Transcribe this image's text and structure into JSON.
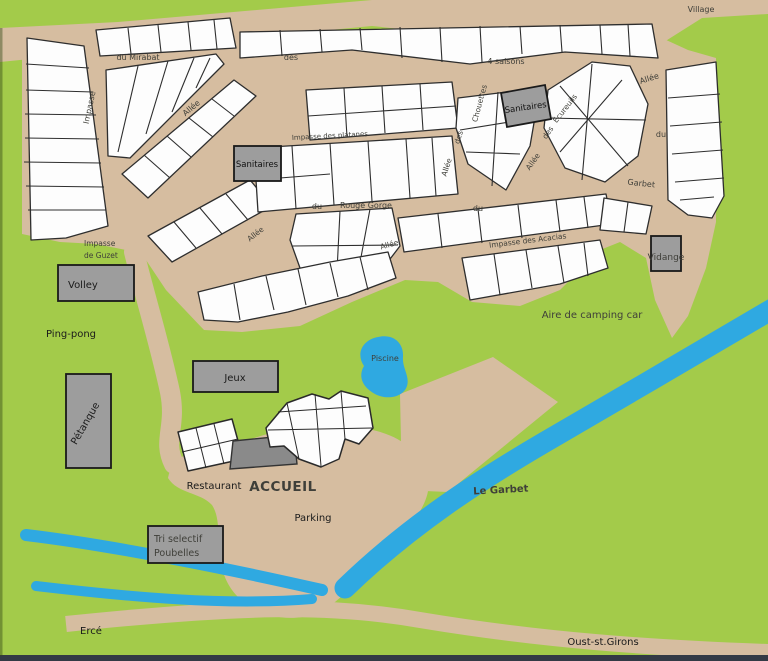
{
  "colors": {
    "green": "#a3cb4a",
    "tan": "#d6bda0",
    "water": "#2fa9e1",
    "plot_fill": "#fdfdfd",
    "outline": "#2e2e2e",
    "facility_gray": "#9d9d9d",
    "building_gray": "#8a8a8a",
    "text_dark": "#1b1b1b",
    "text_green": "#2e6b14",
    "text_blue": "#143d6b"
  },
  "labels": {
    "village": "Village",
    "du_mirabat": "du Mirabat",
    "impasse_left": "Impasse",
    "allee_mirabat": "Allée",
    "des_4saisons": "des",
    "quatre_saisons": "4 saisons",
    "impasse_platanes": "Impasse des platanes",
    "sanitaires_top": "Sanitaires",
    "sanitaires_mid": "Sanitaires",
    "chouettes_allee": "Allée",
    "chouettes_des": "des",
    "chouettes_name": "Chouettes",
    "ecureuils_allee": "Allée",
    "ecureuils_des": "des",
    "ecureuils_name": "Écureuils",
    "garbet_allee": "Allée",
    "garbet_du": "du",
    "garbet_name": "Garbet",
    "rouge_gorge_du": "du",
    "rouge_gorge_name": "Rouge Gorge",
    "allee_sw": "Allée",
    "allee_lower": "Allée",
    "du_center": "du",
    "impasse_acacias": "Impasse des Acacias",
    "impasse_guzet_line1": "Impasse",
    "impasse_guzet_line2": "de Guzet",
    "vidange": "Vidange",
    "volley": "Volley",
    "ping_pong": "Ping-pong",
    "aire_camping_car": "Aire de camping car",
    "piscine": "Piscine",
    "jeux": "Jeux",
    "petanque": "Pétanque",
    "restaurant": "Restaurant",
    "accueil": "ACCUEIL",
    "parking": "Parking",
    "tri_line1": "Tri selectif",
    "tri_line2": "Poubelles",
    "le_garbet": "Le Garbet",
    "erce": "Ercé",
    "oust": "Oust-st.Girons"
  }
}
